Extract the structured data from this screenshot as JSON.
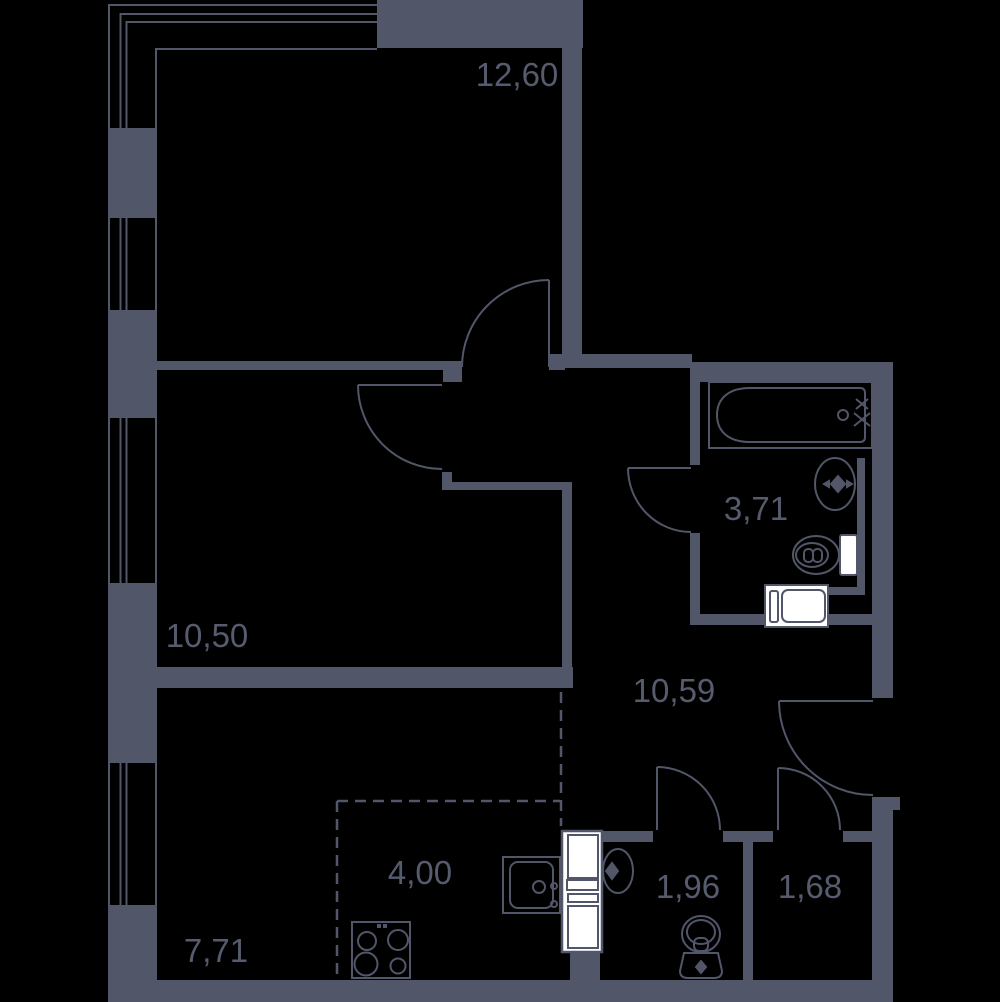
{
  "title": "Apartment floor plan",
  "colors": {
    "wall": "#515668",
    "background": "#000000",
    "fixture_fill": "#ffffff",
    "label_text": "#565c6e"
  },
  "rooms": [
    {
      "name": "room-top",
      "area": "12,60"
    },
    {
      "name": "room-middle",
      "area": "10,50"
    },
    {
      "name": "bathroom",
      "area": "3,71"
    },
    {
      "name": "hallway",
      "area": "10,59"
    },
    {
      "name": "kitchen-zone",
      "area": "4,00"
    },
    {
      "name": "kitchen-living-room",
      "area": "7,71"
    },
    {
      "name": "wc",
      "area": "1,96"
    },
    {
      "name": "storage",
      "area": "1,68"
    }
  ],
  "fixtures": [
    "bathtub",
    "bathroom-sink",
    "bathroom-toilet",
    "washing-machine",
    "ventilation-shaft",
    "wc-sink",
    "wc-toilet",
    "kitchen-sink",
    "stove"
  ]
}
